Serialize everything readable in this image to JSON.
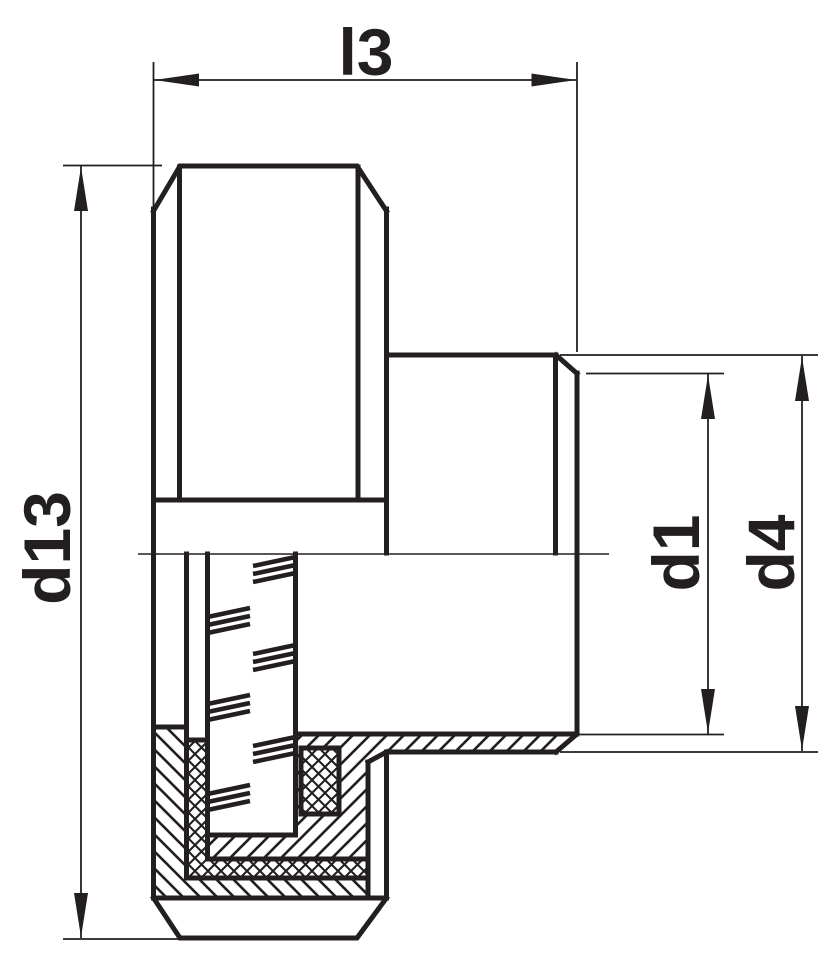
{
  "drawing": {
    "type": "technical-section-drawing",
    "background": "#ffffff",
    "line_color": "#231f20",
    "dimensions": {
      "l3": {
        "label": "l3",
        "orientation": "horizontal",
        "measures": "overall length"
      },
      "d13": {
        "label": "d13",
        "orientation": "vertical",
        "measures": "outer diameter of disc"
      },
      "d1": {
        "label": "d1",
        "orientation": "vertical",
        "measures": "bore diameter of hub"
      },
      "d4": {
        "label": "d4",
        "orientation": "vertical",
        "measures": "outer diameter of hub"
      }
    }
  }
}
